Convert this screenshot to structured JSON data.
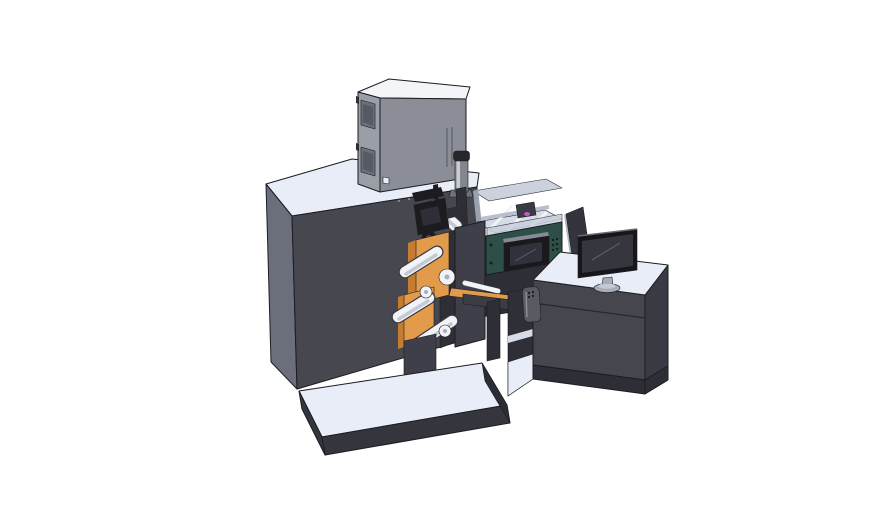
{
  "scene": {
    "title": "3D CAD render of a label printing press with operator console",
    "background": "#ffffff"
  },
  "components": [
    "main-cabinet",
    "electrical-box",
    "exhaust-cylinder",
    "print-head",
    "unwind-station",
    "guide-rollers",
    "web-guide",
    "process-enclosure",
    "control-panel",
    "control-display",
    "support-frame",
    "machine-platform",
    "operator-desk",
    "pendant-remote",
    "monitor",
    "side-guard-panel"
  ],
  "colors": {
    "outline": "#1c1c22",
    "surface_top": "#e8edf7",
    "surface_top_bright": "#f3f5f9",
    "cabinet_front": "#474750",
    "cabinet_side": "#6b6f7c",
    "platform_side": "#35353e",
    "platform_side_dark": "#2c2c34",
    "box_left": "#9a9ea7",
    "box_right": "#8b8e96",
    "box_window": "#6b6f79",
    "box_window_inner": "#565a64",
    "box_slit": "#5c5f66",
    "cylinder_body": "#83868e",
    "cylinder_highlight": "#c8ccd3",
    "cylinder_cap": "#26262b",
    "cylinder_base": "#6f727a",
    "enclosure_wall": "#c9d0dd",
    "wall_edge": "#9aa0ac",
    "enclosure_floor": "#d6dce8",
    "rail_white": "#f2f4f8",
    "rail_silver": "#b9bfcc",
    "carriage": "#3a3a42",
    "magenta": "#c355c9",
    "teal_panel": "#2e4f47",
    "display_top": "#878b95",
    "display_bezel": "#1a1a1e",
    "display_screen": "#30323b",
    "screen_glare": "#5a5c66",
    "mech_black": "#1b1b20",
    "mech_dark": "#2e2e36",
    "hub_inner": "#50525c",
    "plate_dark": "#3f3f49",
    "orange": "#e29a4b",
    "orange_dark": "#c67c30",
    "roller": "#f1f3f7",
    "roller_shade": "#c4c9d3",
    "roller_edge": "#3a3a40",
    "stub_inner": "#aab0bb",
    "beam": "#3c3c45",
    "bay_dark": "#2f2f38",
    "desk_front": "#46464f",
    "desk_side": "#3a3a44",
    "desk_plinth": "#2e2e37",
    "desk_seam": "#26262c",
    "guard_panel": "#33343c",
    "guard_edge": "#b3b8c2",
    "pendant": "#595b62",
    "pendant_light": "#8a8c93",
    "monitor_bezel": "#17171b",
    "monitor_screen": "#35363e",
    "monitor_edge": "#6a6c75",
    "stand_gray": "#a7adb8",
    "stand_light": "#c3c8d2",
    "dot_gray": "#9098a4"
  }
}
